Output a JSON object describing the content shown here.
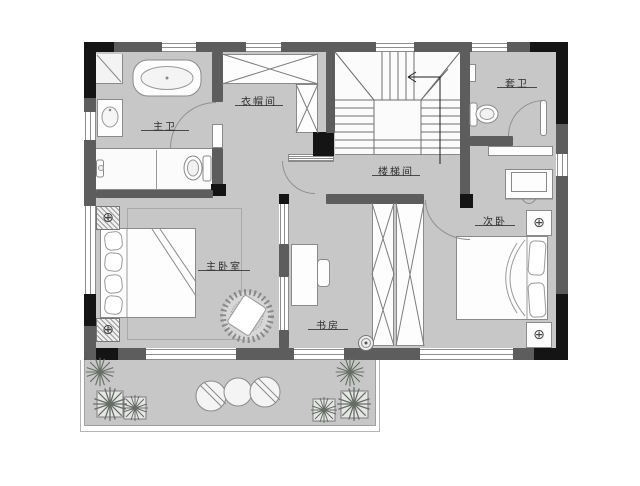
{
  "plan": {
    "rooms": {
      "master_bath": "主卫",
      "cloakroom": "衣帽间",
      "stairwell": "楼梯间",
      "ensuite_bath": "套卫",
      "second_bedroom": "次卧",
      "master_bedroom": "主卧室",
      "study": "书房"
    },
    "icons": {
      "lamp_symbol": "⊕"
    },
    "colors": {
      "floor": "#c7c7c7",
      "wall": "#5d5d5d",
      "wall_dark": "#141414",
      "line": "#8a8a8a"
    }
  }
}
